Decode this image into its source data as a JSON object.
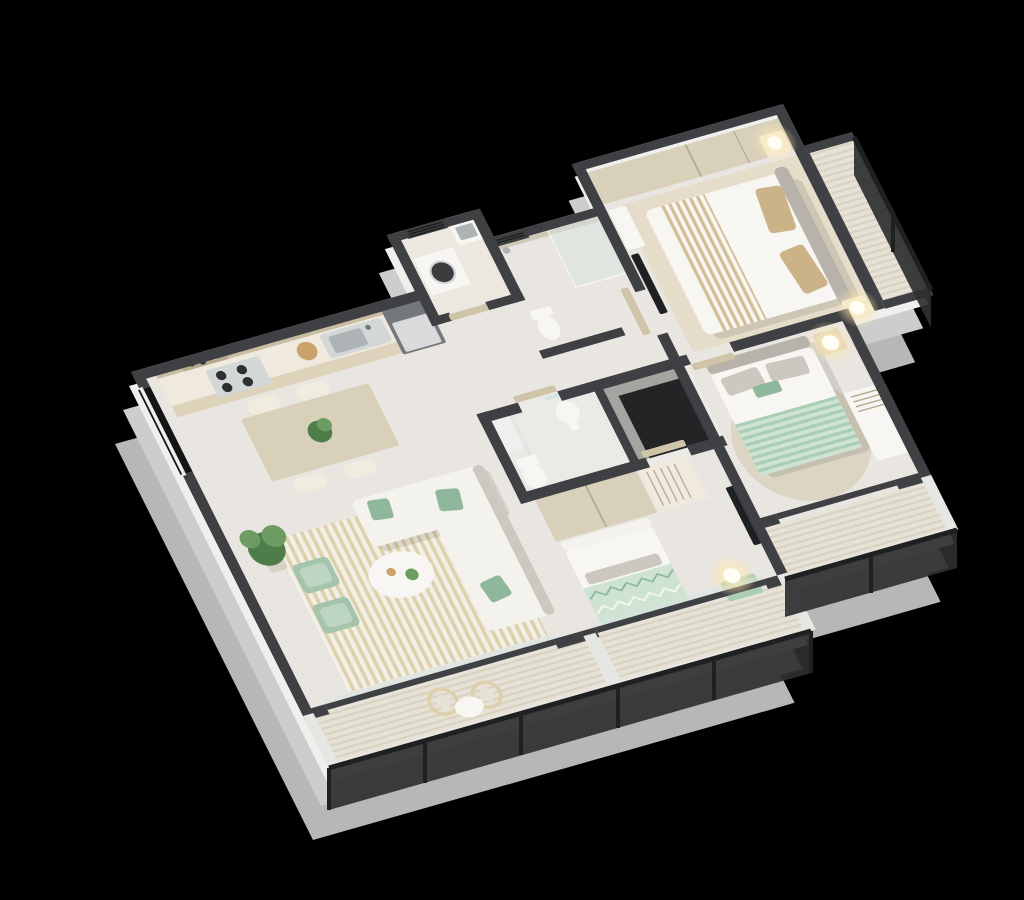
{
  "scene": {
    "type": "isometric-3d-floor-plan-render",
    "description": "Cutaway 3D isometric render of a three-bedroom apartment with balconies",
    "background": "#000000"
  },
  "palette": {
    "background": "#000000",
    "wall": "#3e4043",
    "exterior_face_3": "#b7b7b5",
    "exterior_face_2": "#cdcdcb",
    "slab": "#efefed",
    "floor": "#e9e6e1",
    "floor_bath": "#eceae6",
    "floor_laundry": "#ece8e0",
    "deck": "#e7e2d6",
    "deck_line": "#d8d2c2",
    "divider_light": "#e6e6e3",
    "wood": "#d9d0ba",
    "wood_dark": "#c8bda2",
    "wood_seam": "#b4aa8f",
    "counter": "#efeadd",
    "cabinet_front": "#ddd3ba",
    "steel": "#d4d7d8",
    "steel_dark": "#aeb4b6",
    "appliance_dark": "#75787b",
    "appliance_face": "#d8dadb",
    "white": "#f7f6f2",
    "off_white": "#f1ece0",
    "gray_head": "#b8b3aa",
    "gray_pillow": "#ccc8bf",
    "sofa": "#f4f2ed",
    "cushion_green": "#8fb79b",
    "green_chair": "#a4c4ac",
    "green_chair_seat": "#bdd5c3",
    "mint": "#cfe3d2",
    "mint_deep": "#a9cdb5",
    "zigzag_green": "#8fb79b",
    "rug_base": "#f2efe6",
    "rug_stripe": "#ddd0ab",
    "round_rug": "#dcd5c4",
    "master_rug": "#e5ddca",
    "tan_pillow": "#cbb287",
    "beige_stripe": "#d3bd92",
    "railing": "#2e2f31",
    "railing_dark": "#1f2022",
    "glass": "#d7e4e0",
    "glass_frame": "#3f4144",
    "door_wood": "#cfc4a8",
    "vent_dark": "#3a3c3e",
    "vent_slat": "#17181a",
    "tile": "#cfc8b6",
    "shaft_face": "#a5a4a0",
    "shaft_dark": "#232425",
    "window_void": "#141415",
    "lamp_glow_core": "#fff6d8",
    "lamp_glow": "#ffe9b0",
    "lamp_body": "#fffdf4",
    "plant_dark": "#4f7d4a",
    "plant_light": "#6d9c63",
    "pot": "#d8d2c4",
    "board": "#caa36a",
    "shadow": "rgba(0,0,0,0.10)"
  },
  "rooms": [
    {
      "name": "kitchen",
      "furniture": [
        "upper-cabinets",
        "open-shelf",
        "gas-stove",
        "countertop",
        "kitchen-sink",
        "cutting-board",
        "refrigerator"
      ]
    },
    {
      "name": "laundry-room",
      "furniture": [
        "washing-machine",
        "utility-basin",
        "ac-vent"
      ]
    },
    {
      "name": "ensuite-bathroom",
      "furniture": [
        "walk-in-shower",
        "toilet",
        "tiled-wall",
        "shower-head"
      ]
    },
    {
      "name": "master-bedroom",
      "furniture": [
        "sliding-wardrobe",
        "double-bed",
        "striped-runner",
        "area-rug",
        "nightstand-north",
        "nightstand-south",
        "table-lamp-north",
        "table-lamp-south",
        "tv-panel",
        "dresser"
      ]
    },
    {
      "name": "master-balcony",
      "furniture": [
        "metal-railing"
      ]
    },
    {
      "name": "main-bathroom",
      "furniture": [
        "toilet",
        "pedestal-sink",
        "mirror",
        "shower-tray"
      ]
    },
    {
      "name": "service-shaft",
      "furniture": []
    },
    {
      "name": "bedroom-2",
      "furniture": [
        "double-bed",
        "round-rug",
        "nightstand",
        "table-lamp",
        "desk-with-organizer",
        "door"
      ]
    },
    {
      "name": "bedroom-2-balcony",
      "furniture": [
        "metal-railing"
      ]
    },
    {
      "name": "bedroom-3",
      "furniture": [
        "wardrobe",
        "open-shelf-unit",
        "single-bed",
        "zigzag-blanket",
        "tv-panel",
        "bedside-lamp",
        "mint-side-table",
        "door"
      ]
    },
    {
      "name": "bedroom-3-balcony",
      "furniture": [
        "metal-railing"
      ]
    },
    {
      "name": "living-dining-room",
      "furniture": [
        "dining-table",
        "dining-stools",
        "centerpiece-plant",
        "potted-plant",
        "striped-rug",
        "corner-sofa",
        "green-cushions",
        "coffee-table",
        "lounge-chair-1",
        "lounge-chair-2"
      ]
    },
    {
      "name": "living-balcony",
      "furniture": [
        "rattan-chair-1",
        "rattan-chair-2",
        "bistro-table",
        "metal-railing",
        "sliding-glass-door"
      ]
    }
  ]
}
